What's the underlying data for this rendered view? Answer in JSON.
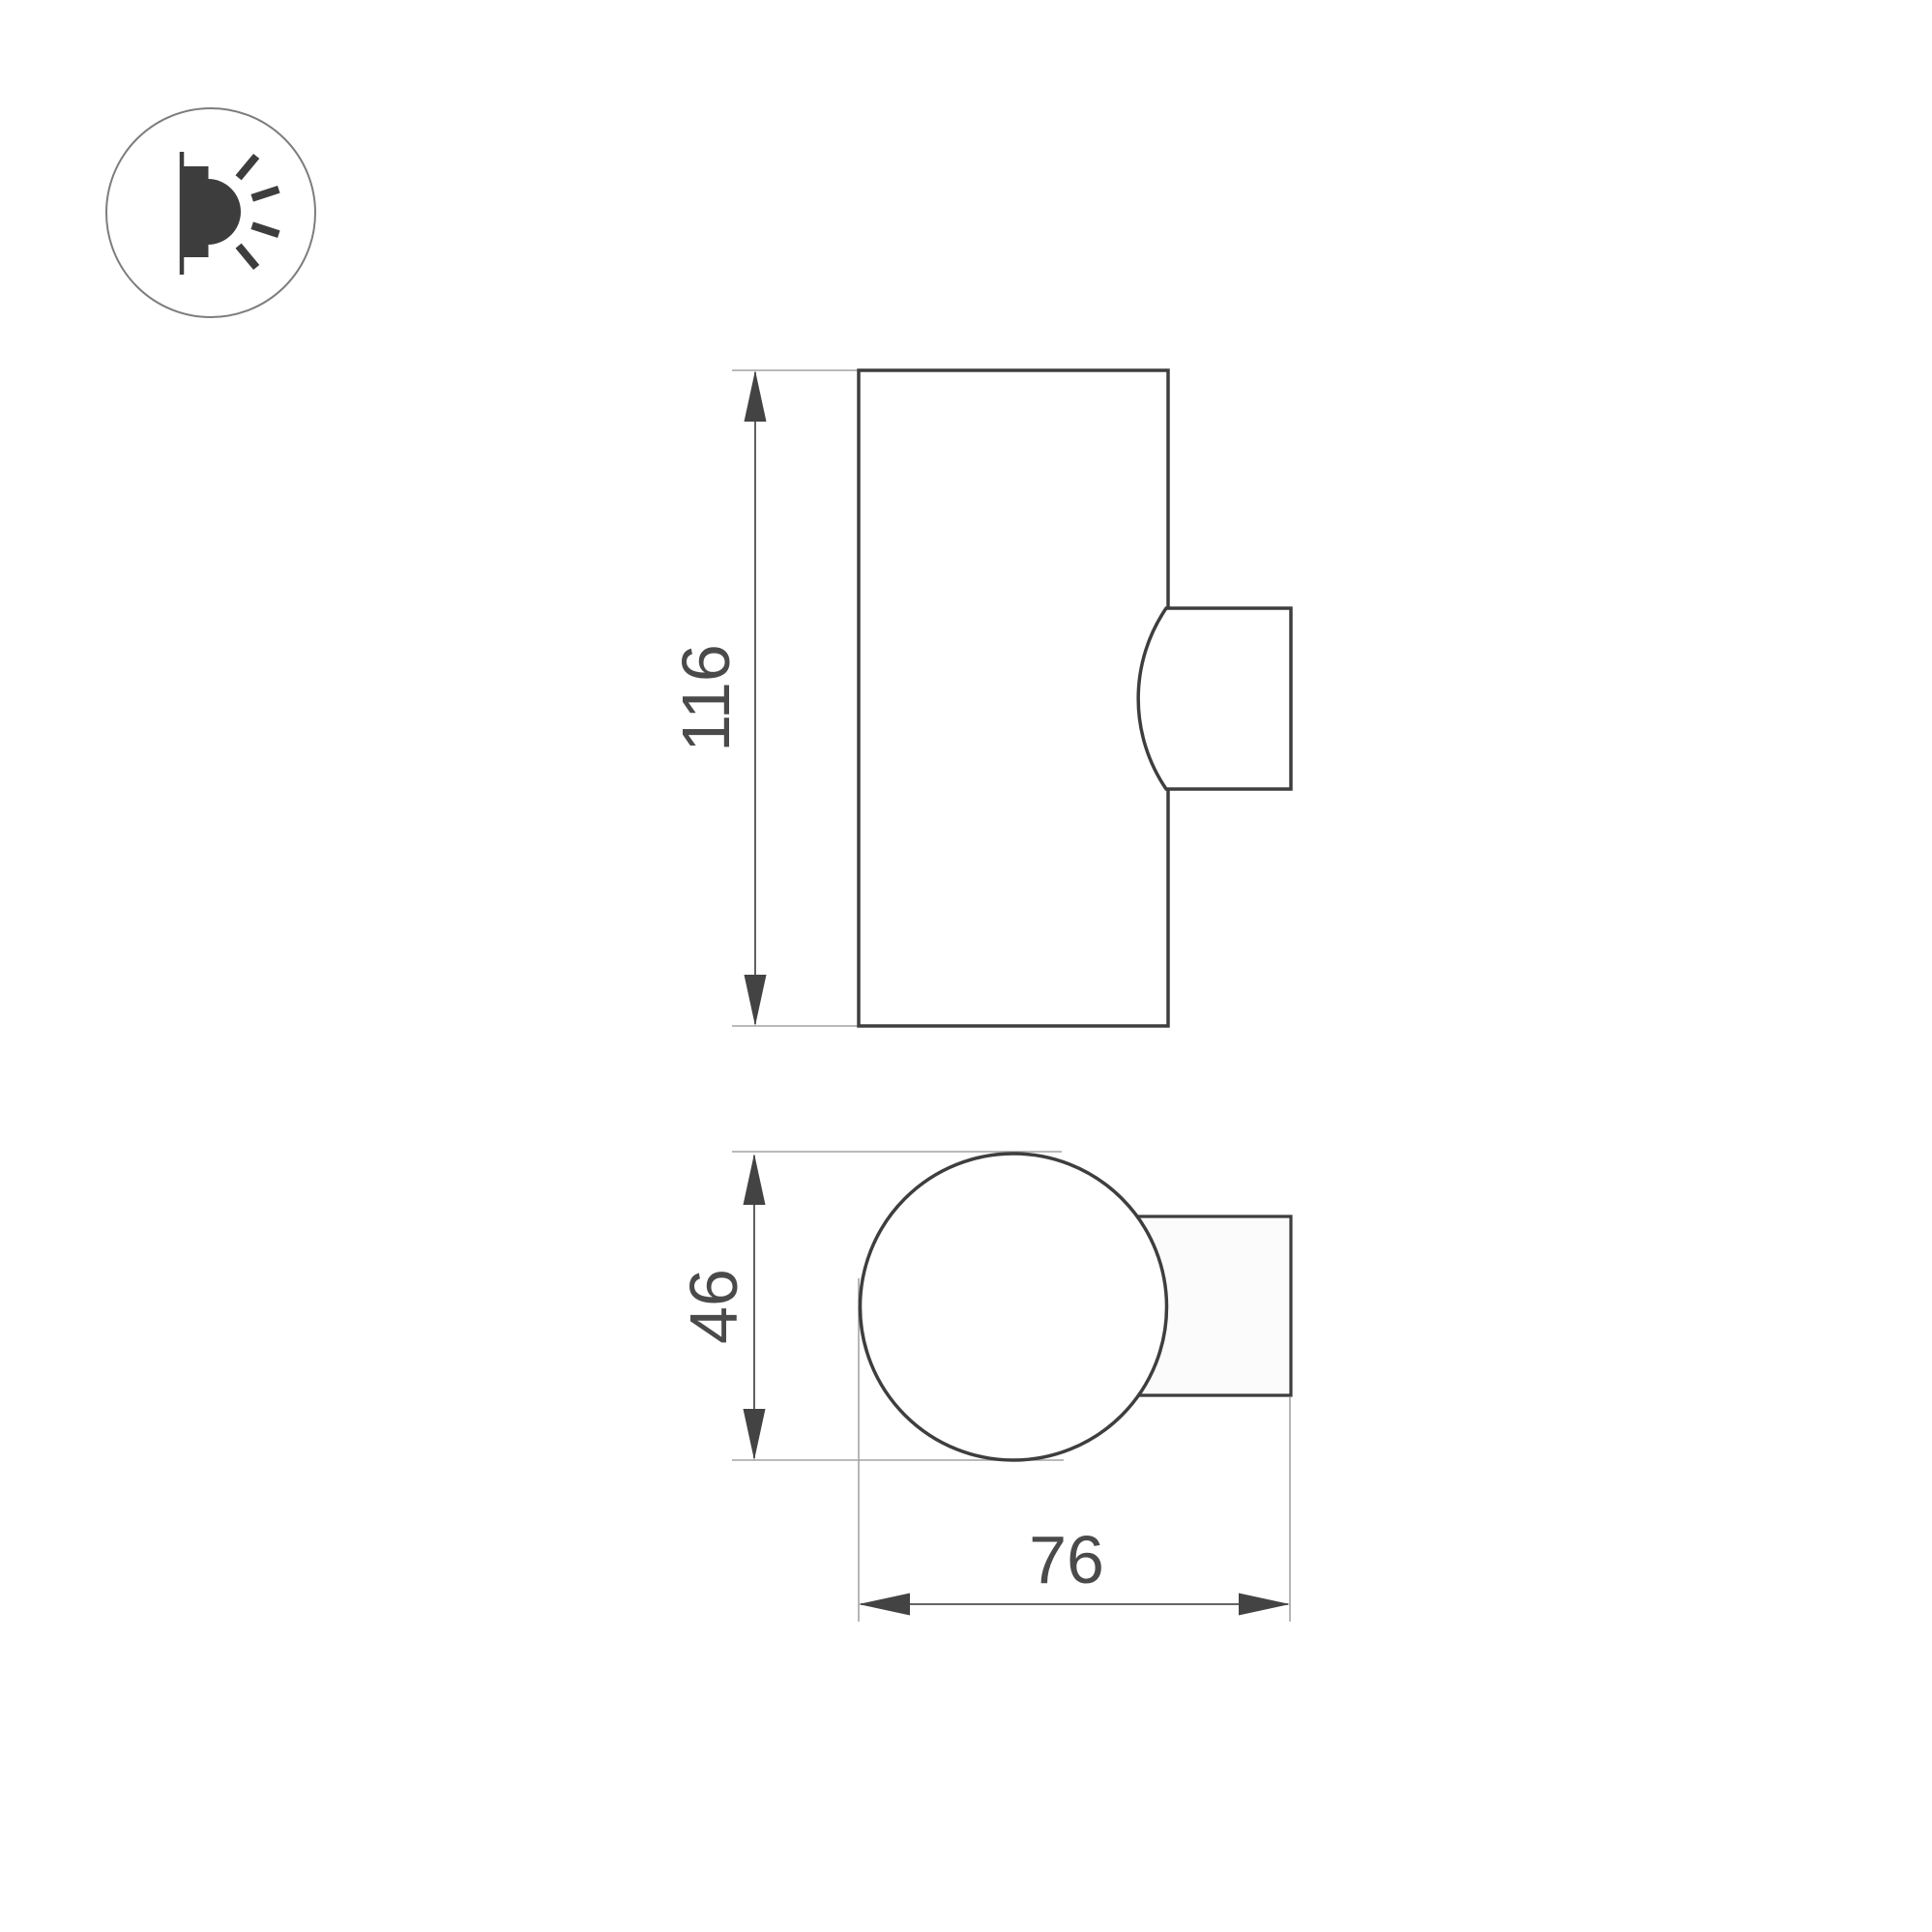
{
  "icon": {
    "name": "wall-lamp-sconce-icon"
  },
  "dimensions": {
    "height_label": "116",
    "diameter_label": "46",
    "width_label": "76"
  },
  "colors": {
    "outline": "#3e3e3e",
    "fill_body": "#ffffff",
    "mount_fill": "#fbfbfb",
    "dimension_line": "#4f4f4f",
    "extension_line": "#a3a3a3",
    "arrow": "#434343",
    "label_text": "#4a4a4a",
    "icon_glyph": "#3d3d3d",
    "icon_circle": "#7d7d7d",
    "background": "#ffffff"
  }
}
